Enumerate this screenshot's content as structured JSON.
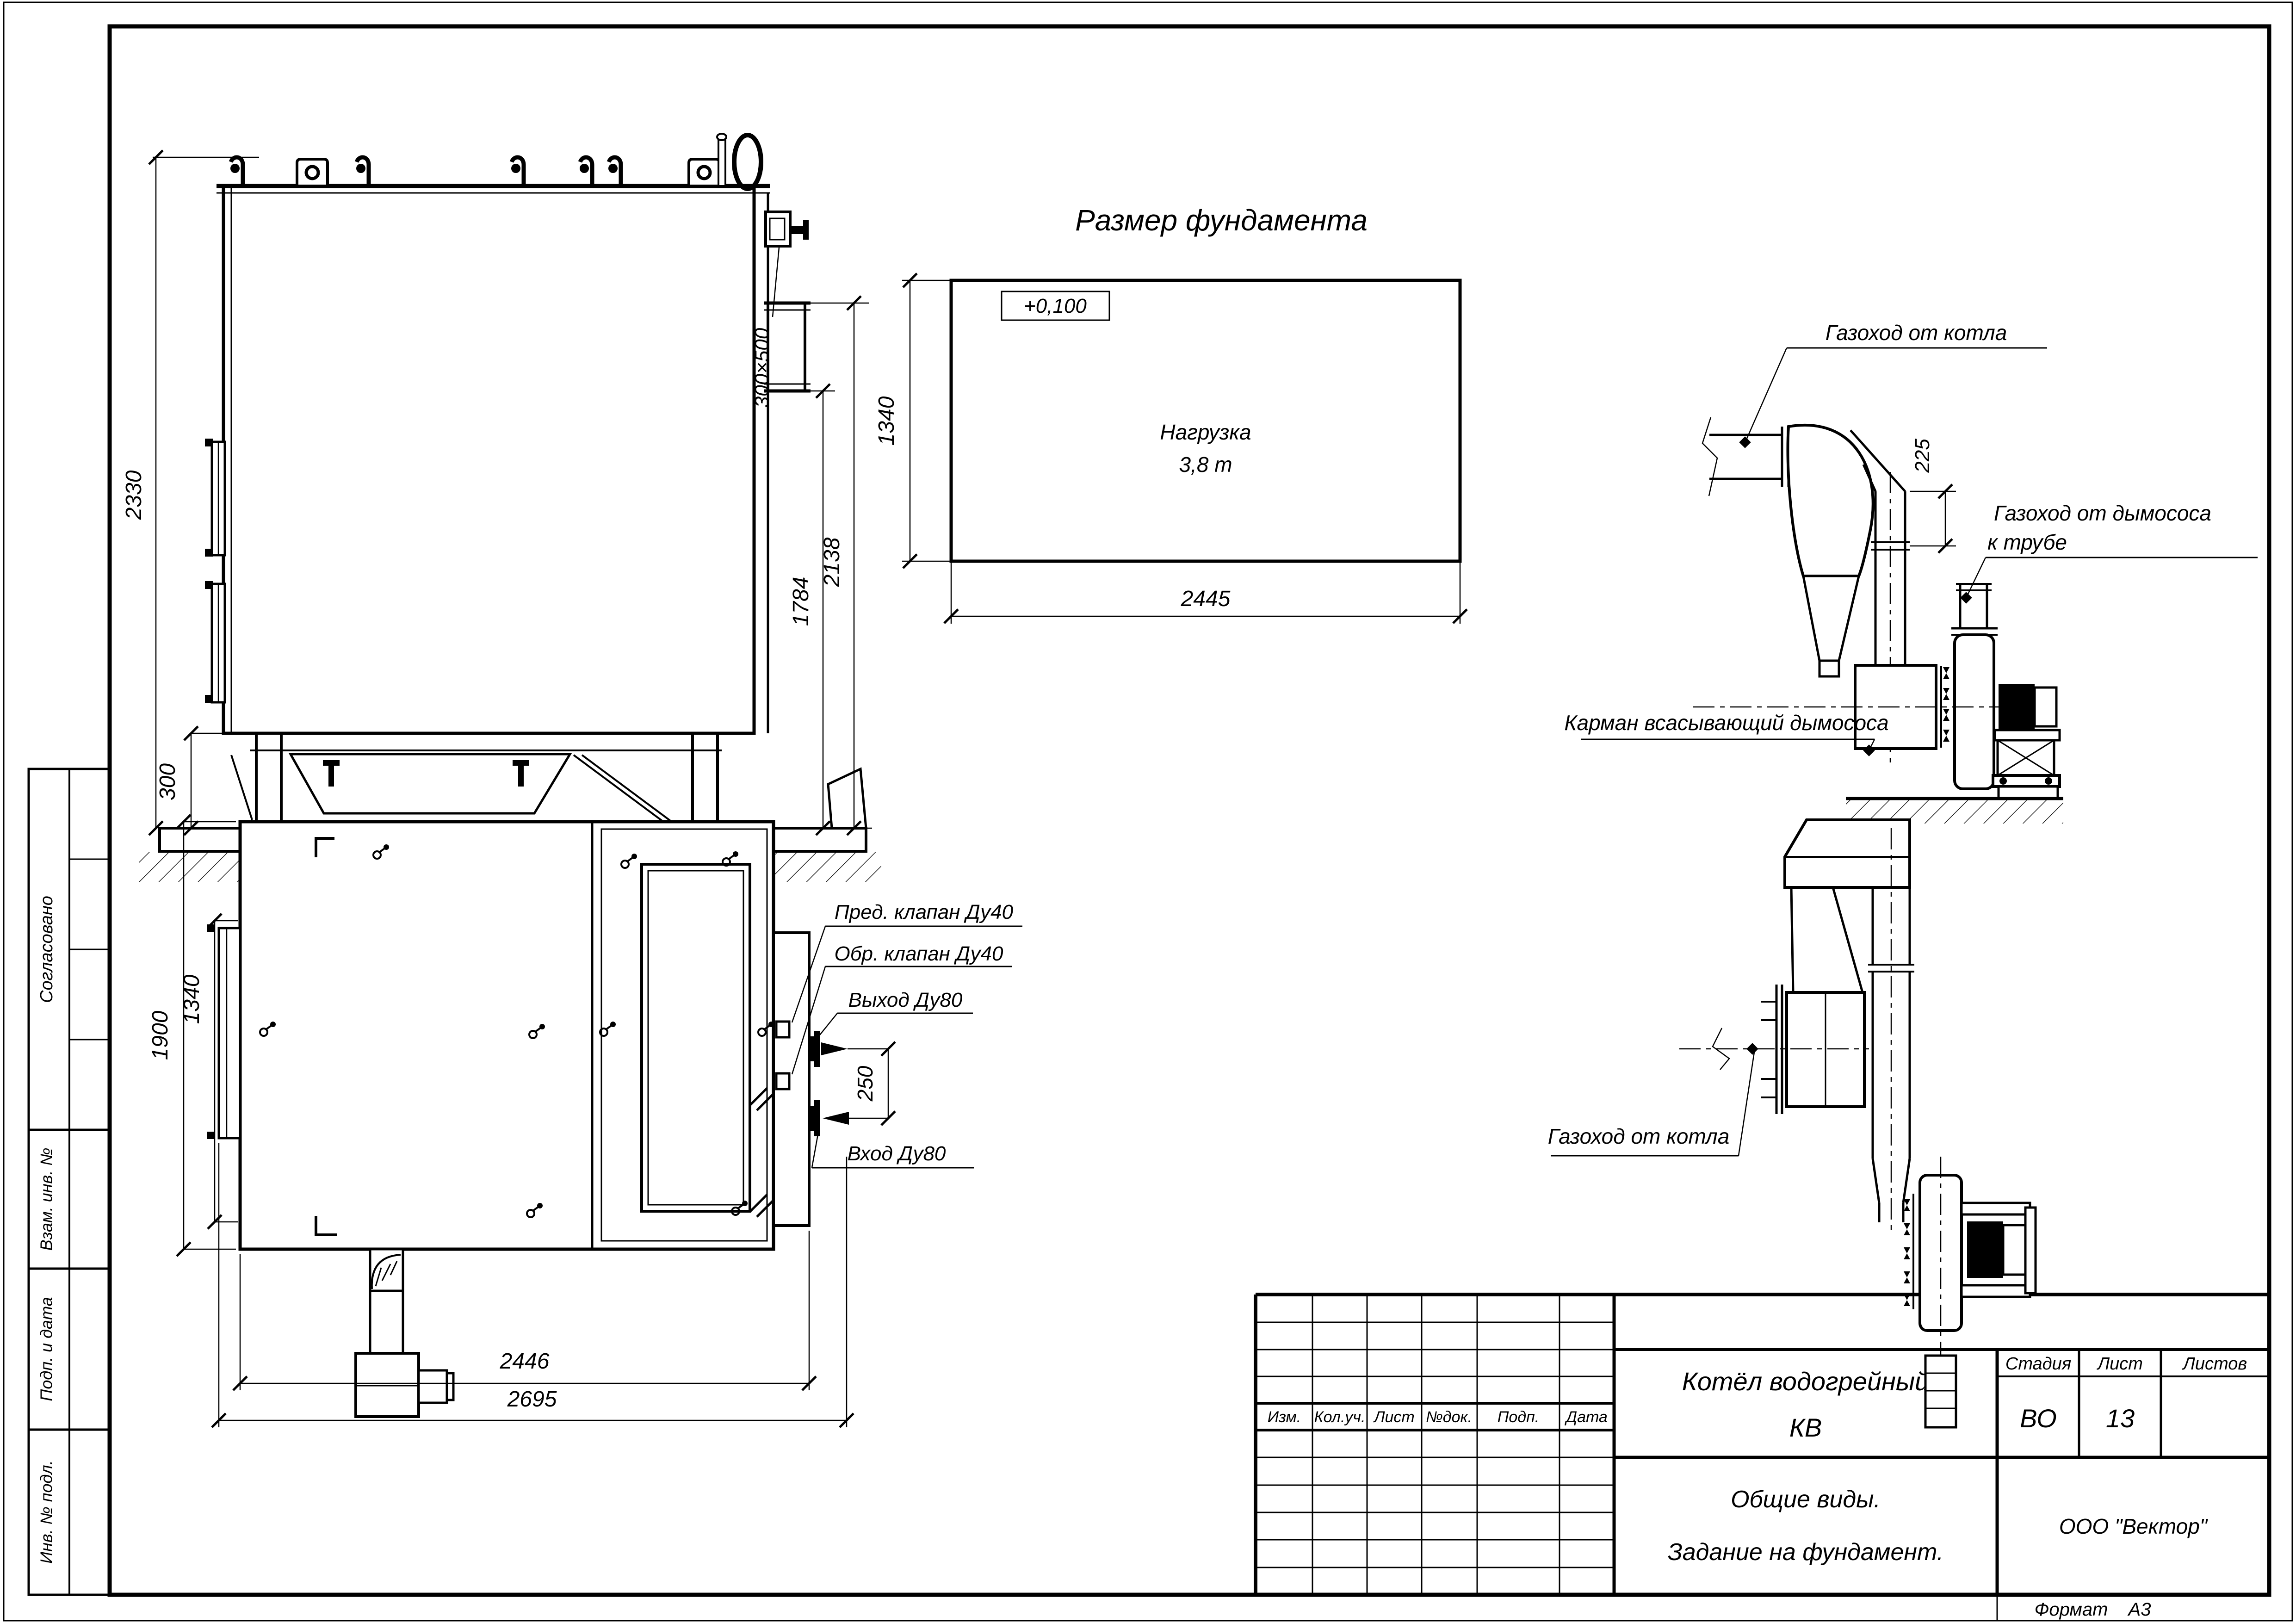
{
  "format": {
    "label": "Формат",
    "value": "А3"
  },
  "margin": {
    "agreed": "Согласовано",
    "vzam": "Взам. инв. №",
    "podp": "Подп. и дата",
    "inv": "Инв. № подл."
  },
  "titleblock": {
    "header": [
      "Изм.",
      "Кол.уч.",
      "Лист",
      "№док.",
      "Подп.",
      "Дата"
    ],
    "title_line1": "Котёл водогрейный",
    "title_line2": "КВ",
    "stage_label": "Стадия",
    "sheet_label": "Лист",
    "sheets_label": "Листов",
    "stage_value": "ВО",
    "sheet_value": "13",
    "subtitle_line1": "Общие виды.",
    "subtitle_line2": "Задание на фундамент.",
    "company": "ООО \"Вектор\""
  },
  "side_view": {
    "dim_height": "2330",
    "dim_support": "300",
    "dim_flue": "300×500",
    "dim_h1": "1784",
    "dim_h2": "2138"
  },
  "foundation": {
    "title": "Размер фундамента",
    "level": "+0,100",
    "load_line1": "Нагрузка",
    "load_line2": "3,8 т",
    "dim_width": "2445",
    "dim_depth": "1340"
  },
  "duct_side": {
    "label_from_boiler": "Газоход от котла",
    "dim_offset": "225",
    "label_to_chimney1": "Газоход от дымососа",
    "label_to_chimney2": "к трубе",
    "label_pocket": "Карман всасывающий дымососа"
  },
  "duct_plan": {
    "label_from_boiler": "Газоход от котла"
  },
  "plan_view": {
    "dim_width": "1900",
    "dim_inner": "1340",
    "dim_len1": "2446",
    "dim_len2": "2695",
    "dim_gap": "250",
    "label_safety": "Пред. клапан Ду40",
    "label_check": "Обр. клапан Ду40",
    "label_outlet": "Выход Ду80",
    "label_inlet": "Вход Ду80"
  }
}
